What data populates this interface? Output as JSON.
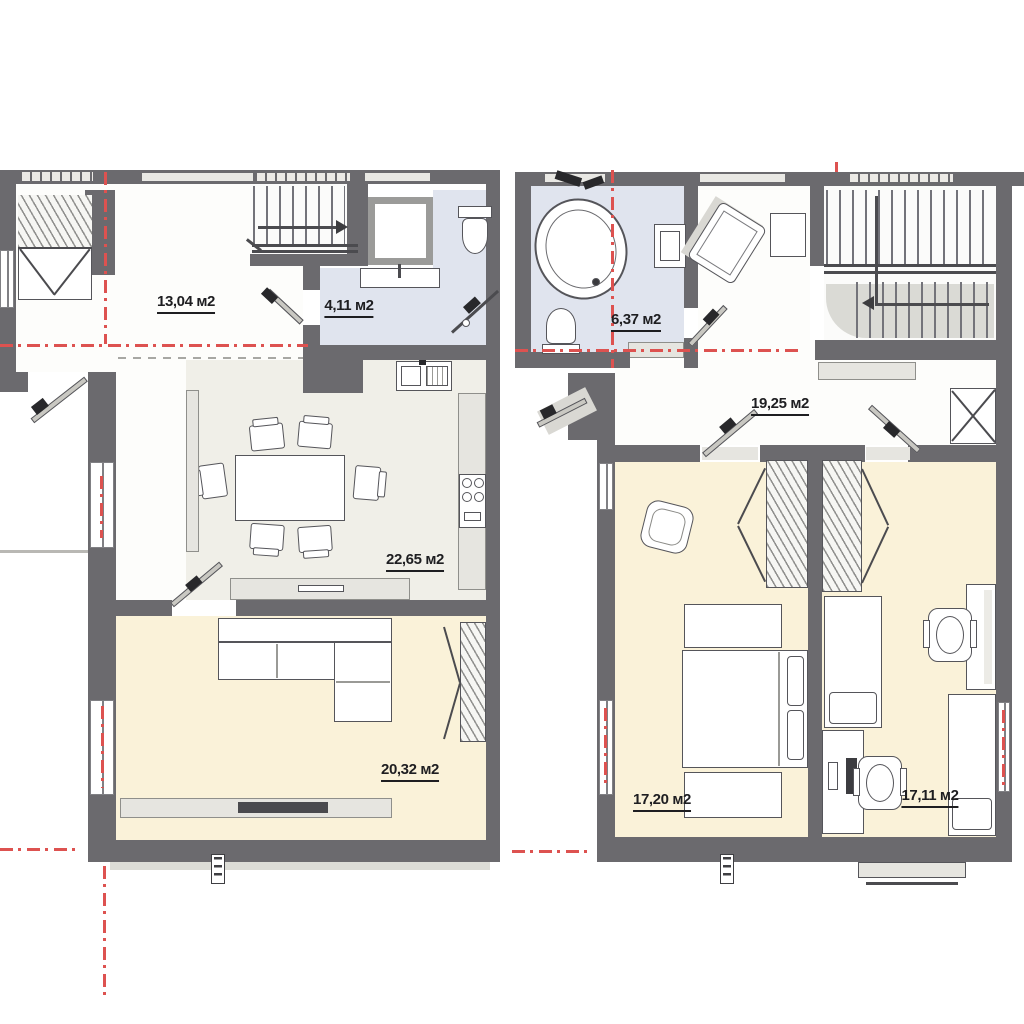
{
  "canvas": {
    "width": 1024,
    "height": 1024,
    "background": "#ffffff"
  },
  "colors": {
    "wall": "#6b6a6e",
    "room_neutral": "#fdfdfb",
    "room_kitchen_living": "#f0efe8",
    "room_cream": "#faf2d9",
    "room_bathroom": "#e0e4ee",
    "axis_red": "#dd5250",
    "furniture_outline": "#55555a",
    "label_text": "#1e1e21"
  },
  "plans": [
    {
      "id": "first-floor",
      "rooms": [
        {
          "name": "hallway",
          "area_label": "13,04 м2"
        },
        {
          "name": "bathroom",
          "area_label": "4,11 м2"
        },
        {
          "name": "kitchen-living-room",
          "area_label": "22,65 м2"
        },
        {
          "name": "living-room",
          "area_label": "20,32 м2"
        }
      ]
    },
    {
      "id": "second-floor",
      "rooms": [
        {
          "name": "bathroom",
          "area_label": "6,37 м2"
        },
        {
          "name": "hall",
          "area_label": "19,25 м2"
        },
        {
          "name": "bedroom-left",
          "area_label": "17,20 м2"
        },
        {
          "name": "bedroom-right",
          "area_label": "17,11 м2"
        }
      ]
    }
  ]
}
